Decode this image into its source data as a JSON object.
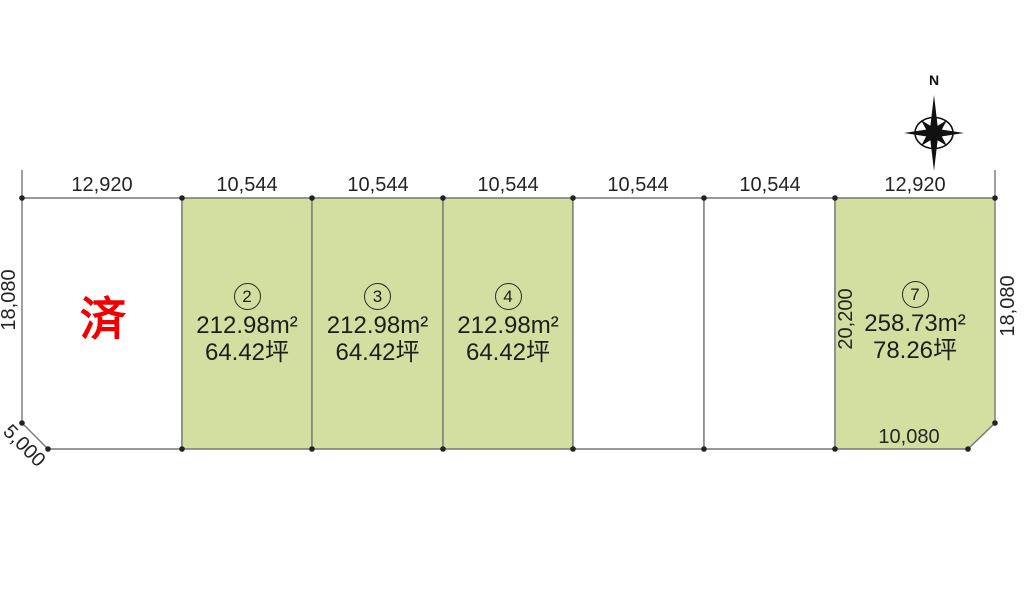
{
  "compass": {
    "north_label": "N"
  },
  "colors": {
    "lot_fill_green": "#d3dfa0",
    "lot_fill_white": "#ffffff",
    "line": "#777777",
    "vertex_dot": "#222222",
    "sold_red": "#f20000"
  },
  "top_dimensions": [
    "12,920",
    "10,544",
    "10,544",
    "10,544",
    "10,544",
    "10,544",
    "12,920"
  ],
  "side_dimensions": {
    "left_height": "18,080",
    "left_chamfer": "5,000",
    "right_height": "18,080",
    "lot7_west_side": "20,200",
    "lot7_bottom": "10,080"
  },
  "lots": [
    {
      "id": "1",
      "status": "済"
    },
    {
      "id": "2",
      "number": "2",
      "area": "212.98m²",
      "tsubo": "64.42坪"
    },
    {
      "id": "3",
      "number": "3",
      "area": "212.98m²",
      "tsubo": "64.42坪"
    },
    {
      "id": "4",
      "number": "4",
      "area": "212.98m²",
      "tsubo": "64.42坪"
    },
    {
      "id": "5"
    },
    {
      "id": "6"
    },
    {
      "id": "7",
      "number": "7",
      "area": "258.73m²",
      "tsubo": "78.26坪"
    }
  ]
}
